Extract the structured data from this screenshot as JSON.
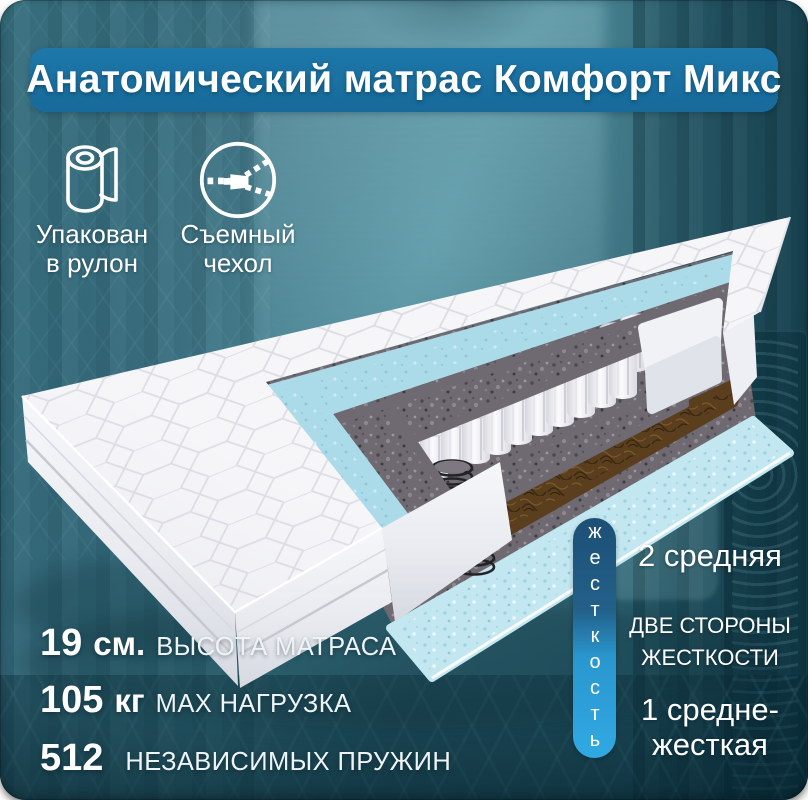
{
  "title": "Анатомический матрас Комфорт Микс",
  "badges": [
    {
      "icon": "roll-icon",
      "line1": "Упакован",
      "line2": "в рулон"
    },
    {
      "icon": "zipper-icon",
      "line1": "Съемный",
      "line2": "чехол"
    }
  ],
  "stats": [
    {
      "value": "19",
      "unit": "см.",
      "label": "ВЫСОТА МАТРАСА"
    },
    {
      "value": "105",
      "unit": "кг",
      "label": "MAX НАГРУЗКА"
    },
    {
      "value": "512",
      "unit": "",
      "label": "НЕЗАВИСИМЫХ ПРУЖИН"
    }
  ],
  "hardness": {
    "scale_label": "жесткость",
    "side_top": "2 средняя",
    "middle_line1": "ДВЕ СТОРОНЫ",
    "middle_line2": "ЖЕСТКОСТИ",
    "bottom_line1": "1 средне-",
    "bottom_line2": "жесткая"
  },
  "colors": {
    "banner_blue": "#1a71a1",
    "scale_gradient_top": "#1d4f76",
    "scale_gradient_bottom": "#31a9e3",
    "background_teal": "#2e6575",
    "quilt_white": "#f6f6f9",
    "layer_foam_blue": "#abdae8",
    "layer_felt_grey": "#6f6a71",
    "layer_coir_brown": "#5a3e1e",
    "layer_base_blue": "#c2e7f0"
  }
}
